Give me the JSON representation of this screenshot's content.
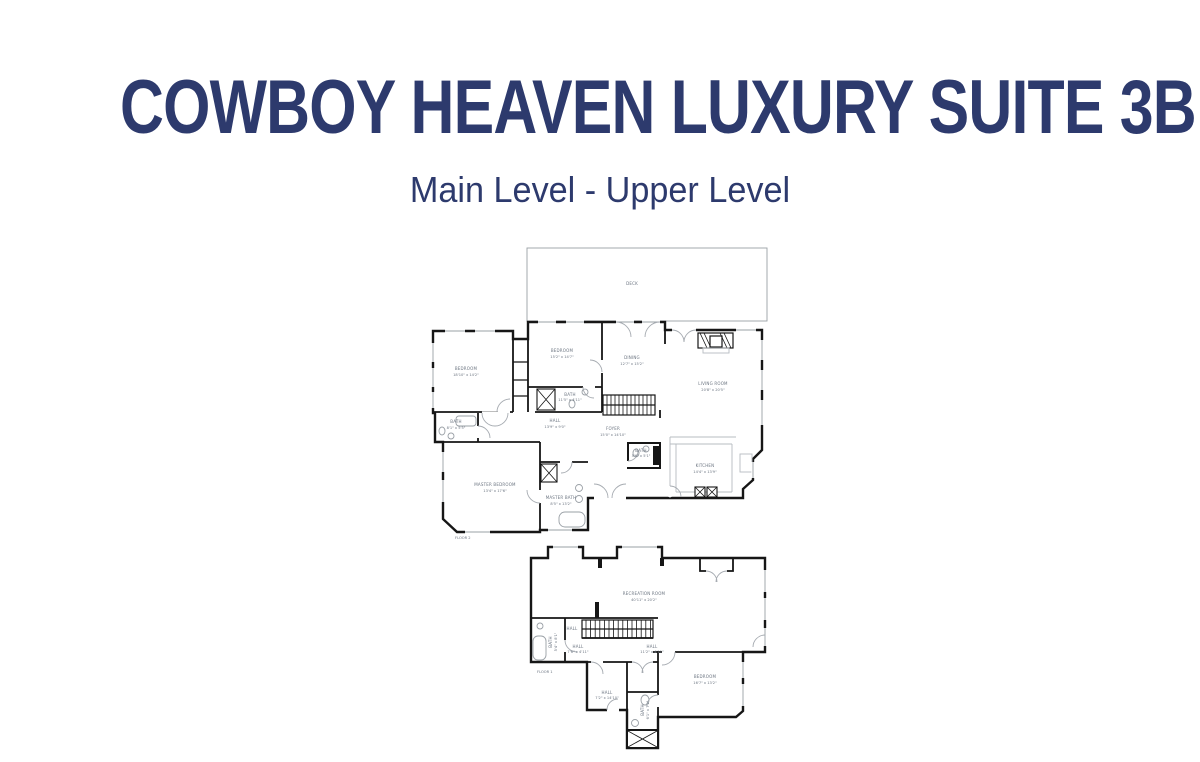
{
  "page": {
    "title": "COWBOY HEAVEN LUXURY SUITE 3B",
    "subtitle": "Main Level - Upper Level",
    "title_color": "#2d3a6d",
    "background": "#ffffff"
  },
  "plan_style": {
    "wall_color": "#161616",
    "window_color": "#9aa0a6",
    "label_color": "#6b7480"
  },
  "floor2": {
    "floor_label": "FLOOR 2",
    "deck_label": "DECK",
    "rooms": [
      {
        "name": "BEDROOM",
        "dims": "18'10\" x 14'2\""
      },
      {
        "name": "BEDROOM",
        "dims": "15'2\" x 14'7\""
      },
      {
        "name": "DINING",
        "dims": "12'7\" x 15'2\""
      },
      {
        "name": "LIVING ROOM",
        "dims": "20'8\" x 20'5\""
      },
      {
        "name": "BATH",
        "dims": "8'1\" x 5'5\""
      },
      {
        "name": "BATH",
        "dims": "11'5\" x 4'11\""
      },
      {
        "name": "HALL",
        "dims": "13'9\" x 9'0\""
      },
      {
        "name": "FOYER",
        "dims": "15'0\" x 14'10\""
      },
      {
        "name": "BATH",
        "dims": "5'6\" x 5'1\""
      },
      {
        "name": "KITCHEN",
        "dims": "14'4\" x 13'9\""
      },
      {
        "name": "MASTER BEDROOM",
        "dims": "13'4\" x 17'6\""
      },
      {
        "name": "MASTER BATH",
        "dims": "8'5\" x 13'2\""
      }
    ]
  },
  "floor1": {
    "floor_label": "FLOOR 1",
    "rooms": [
      {
        "name": "RECREATION ROOM",
        "dims": "40'11\" x 20'2\""
      },
      {
        "name": "BATH",
        "dims": "5'4\" x 8'1\""
      },
      {
        "name": "HALL",
        "dims": ""
      },
      {
        "name": "HALL",
        "dims": "7'6\" x 4'11\""
      },
      {
        "name": "HALL",
        "dims": "11'2\" x 4'11\""
      },
      {
        "name": "HALL",
        "dims": "7'2\" x 14'10\""
      },
      {
        "name": "BATH",
        "dims": "6'1\" x 7'2\""
      },
      {
        "name": "BEDROOM",
        "dims": "16'7\" x 13'2\""
      }
    ]
  }
}
